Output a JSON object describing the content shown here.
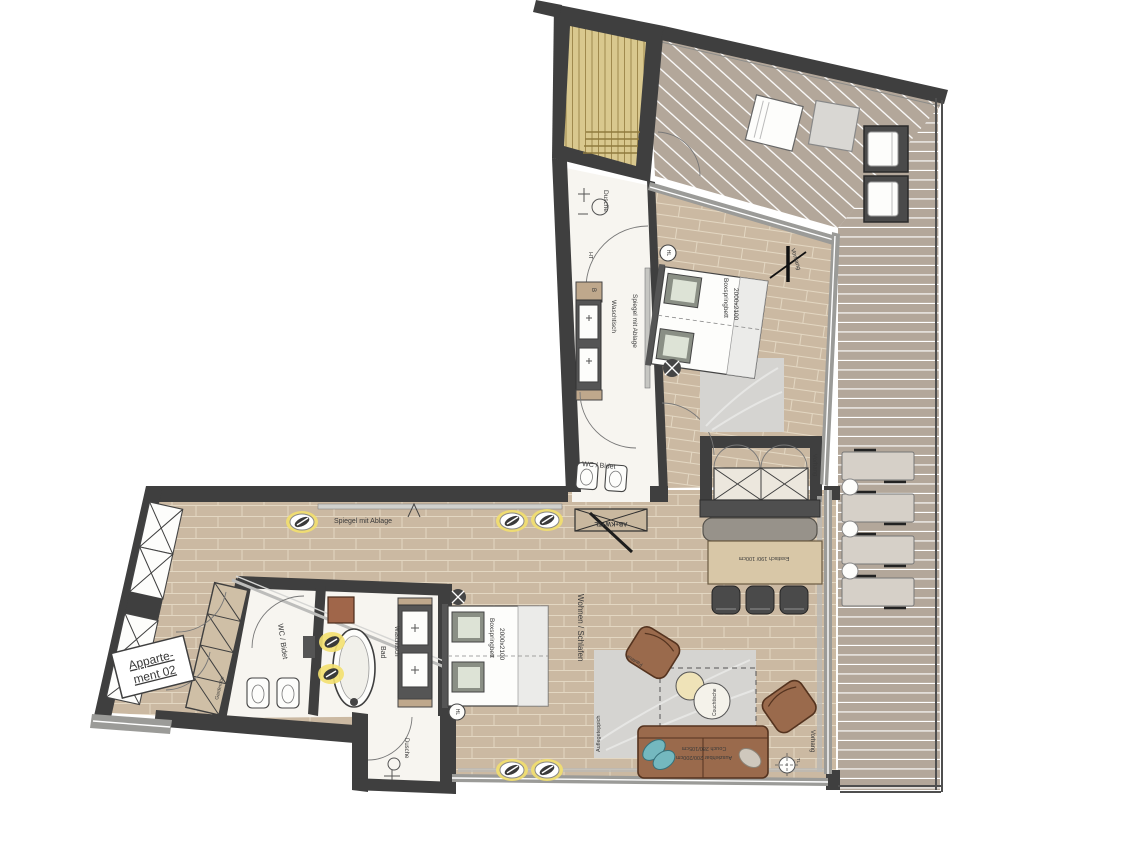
{
  "plan": {
    "title": "Appartement 02",
    "labels": {
      "dusche": "Dusche",
      "waschtisch": "Waschtisch",
      "spiegel": "Spiegel mit Ablage",
      "wc_bidet": "WC / Bidet",
      "bad": "Bad",
      "wohnen_schlafen": "Wohnen / Schlafen",
      "vorhang": "Vorhang",
      "ht": "HT",
      "b": "B",
      "hl": "HL",
      "tl": "TL",
      "anschluss": "AB+KW+TL",
      "apartment_line1": "Apparte-",
      "apartment_line2": "ment 02",
      "bett_line1": "Boxspringbett",
      "bett_line2": "2000x2100",
      "esstisch": "Esstisch 190/ 100cm",
      "couch_line1": "Couch 280/105cm",
      "couch_line2": "Ausziehbar 200/200cm",
      "couchtische": "Couchtische",
      "fauteuil": "Fauteuil",
      "auflegeteppich": "Auflegeteppich",
      "garderobe": "Garderobe"
    },
    "colors": {
      "wall": "#3f3f3f",
      "wood": "#cbb9a2",
      "wood_line": "#e3d7c2",
      "deck": "#b3a79a",
      "deck_line": "#ffffff",
      "bath": "#f7f5f0",
      "sauna": "#d9c88e",
      "sauna_line": "#a08a4e",
      "glass": "#9b9b98",
      "rug": "#d5d4d1",
      "couch": "#9a6a4c",
      "couch_dark": "#54331f",
      "table": "#d8c7a7",
      "chair": "#4a4a4a",
      "glow": "#f3e06e",
      "teal": "#74b8bf",
      "shelf_brown": "#a0664a",
      "text": "#3a3a3a"
    }
  }
}
